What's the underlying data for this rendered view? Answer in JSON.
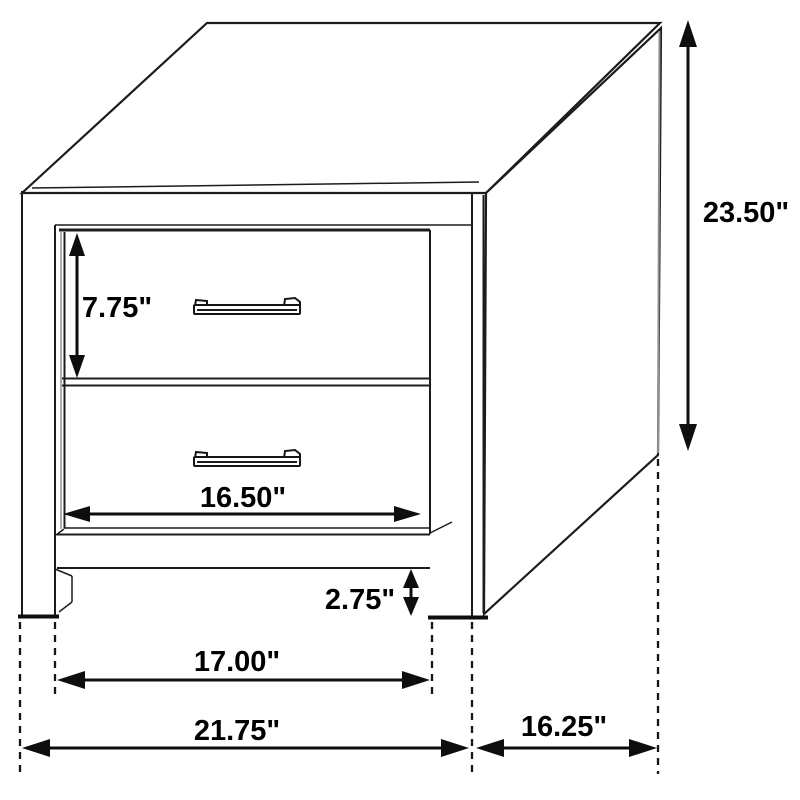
{
  "diagram": {
    "title": "Nightstand dimension drawing",
    "unit": "inches"
  },
  "dims": {
    "drawer_height": {
      "label": "7.75\"",
      "inches": 7.75
    },
    "overall_height": {
      "label": "23.50\"",
      "inches": 23.5
    },
    "drawer_width": {
      "label": "16.50\"",
      "inches": 16.5
    },
    "leg_height": {
      "label": "2.75\"",
      "inches": 2.75
    },
    "inner_width": {
      "label": "17.00\"",
      "inches": 17.0
    },
    "overall_width": {
      "label": "21.75\"",
      "inches": 21.75
    },
    "depth": {
      "label": "16.25\"",
      "inches": 16.25
    }
  },
  "colors": {
    "background": "#ffffff",
    "line": "#1c1c1c",
    "soft_edge": "#8f8f8f"
  }
}
